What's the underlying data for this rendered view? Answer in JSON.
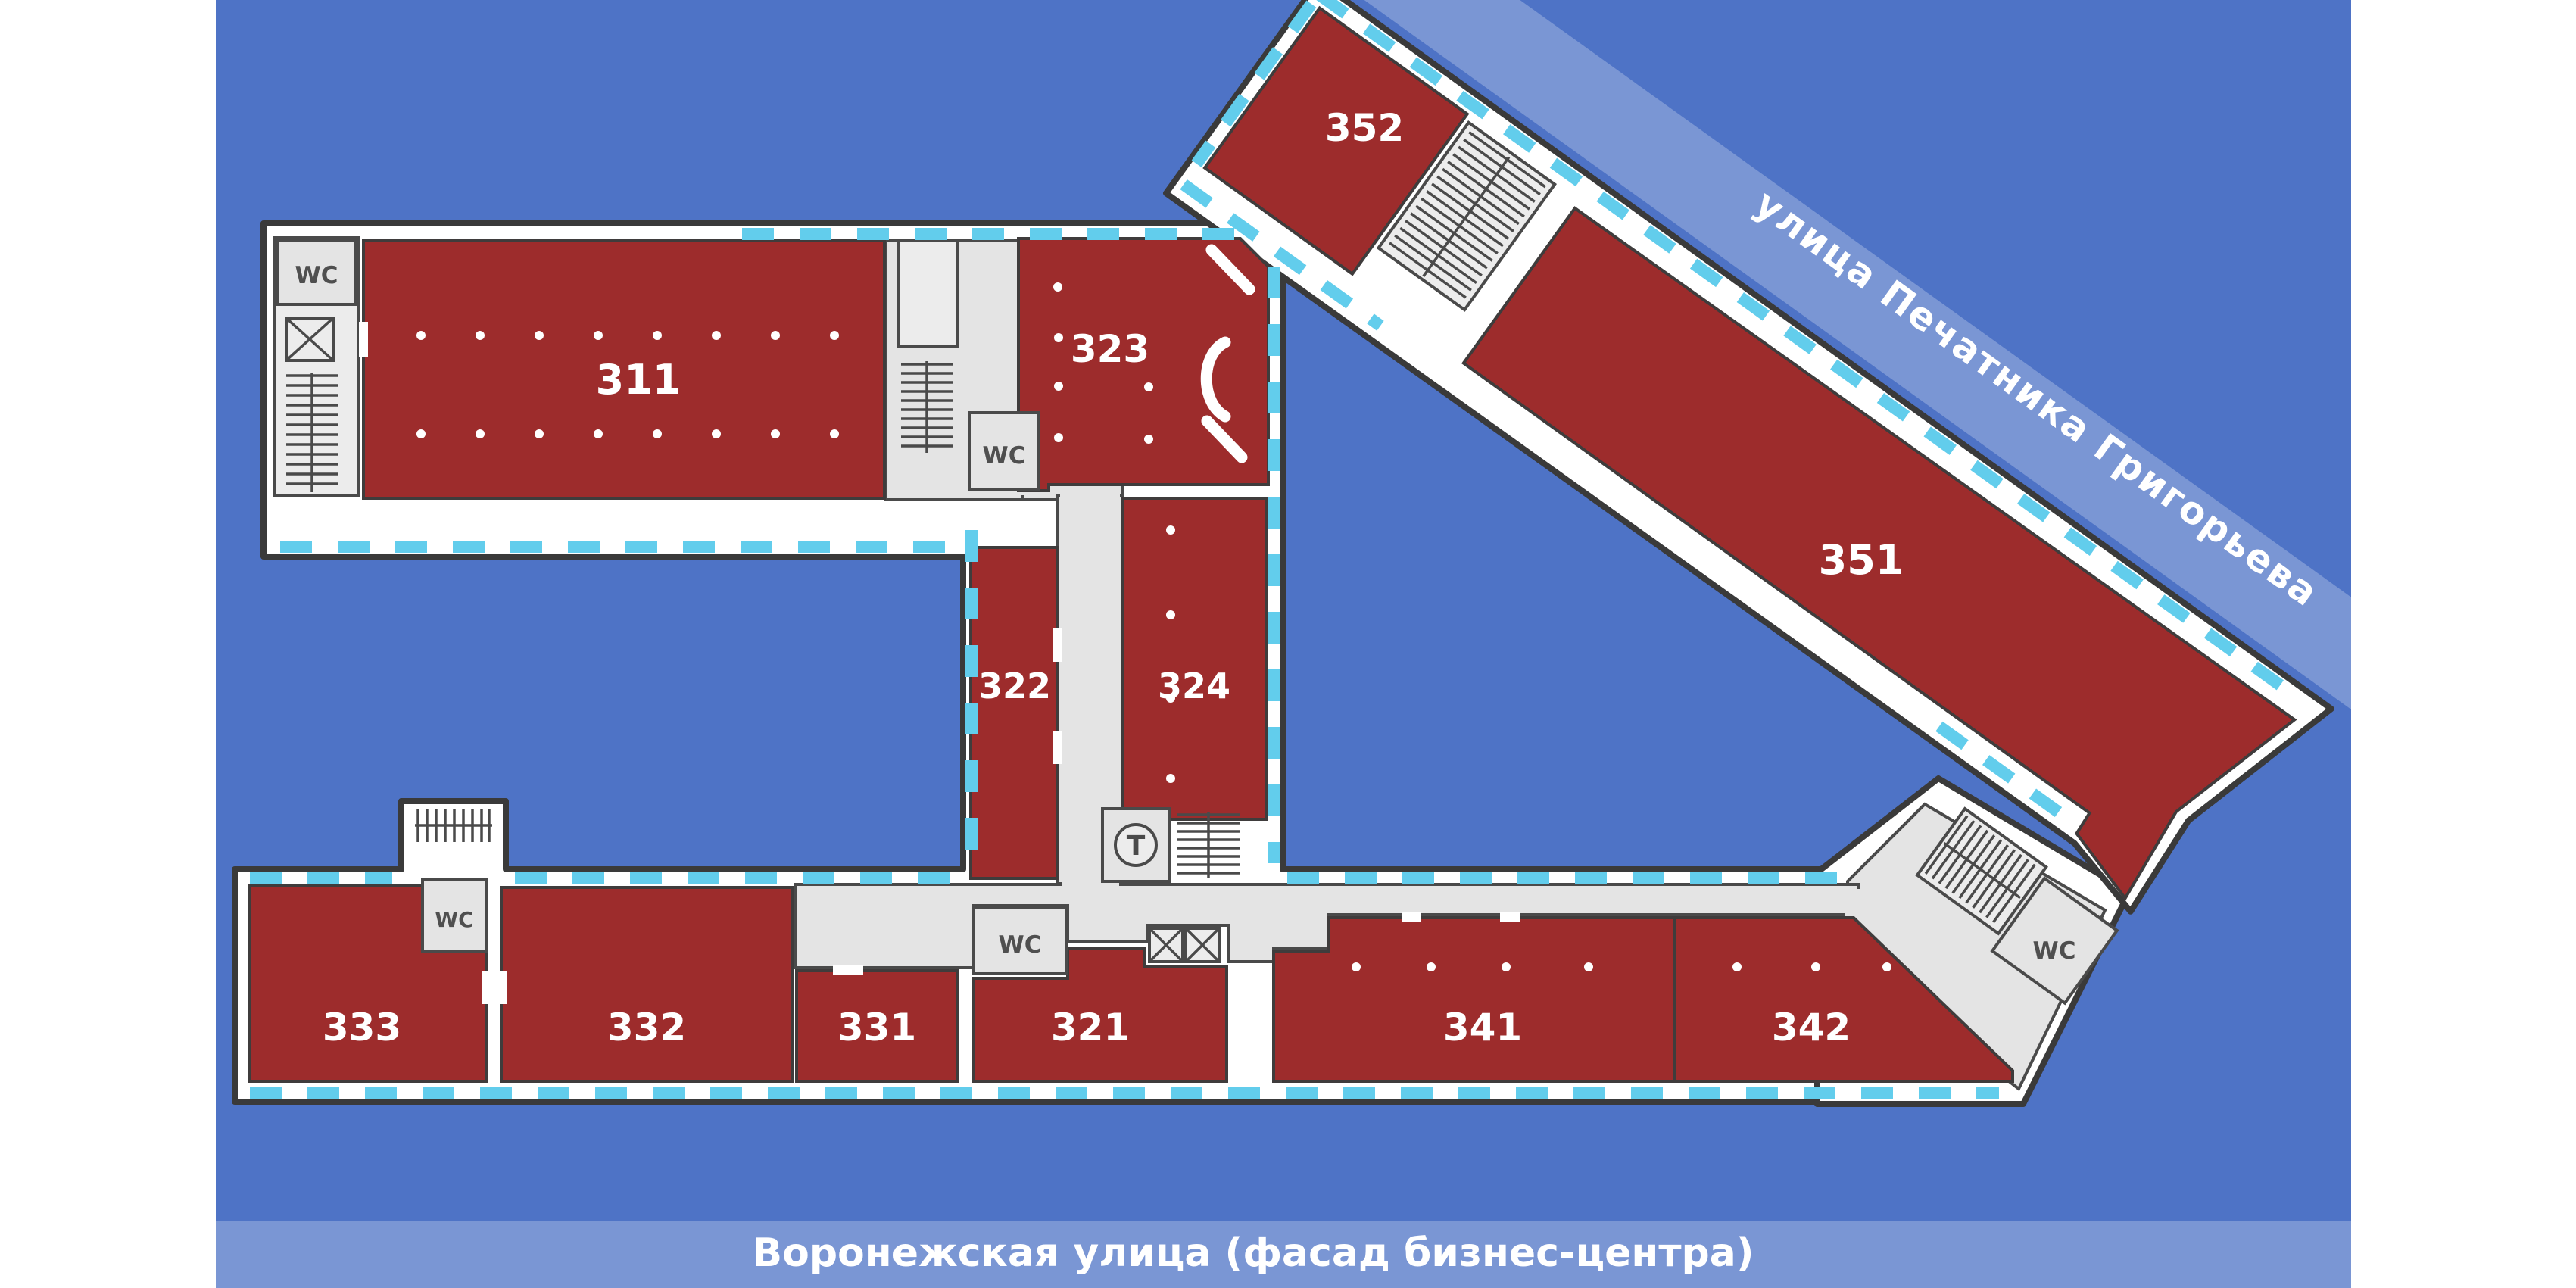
{
  "streets": {
    "diagonal_label": "улица Печатника Григорьева",
    "bottom_label": "Воронежская улица (фасад бизнес-центра)"
  },
  "rooms": {
    "r311": "311",
    "r321": "321",
    "r322": "322",
    "r323": "323",
    "r324": "324",
    "r331": "331",
    "r332": "332",
    "r333": "333",
    "r341": "341",
    "r342": "342",
    "r351": "351",
    "r352": "352"
  },
  "labels": {
    "wc": "WC",
    "t": "T"
  },
  "colors": {
    "page_background": "#ffffff",
    "map_blue": "#4e73c6",
    "street_band": "rgba(255,255,255,0.25)",
    "room_red": "#9d2c2c",
    "wall_white": "#ffffff",
    "outline_dark": "#3a3a3a",
    "interior_gray": "#e4e4e4",
    "window_cyan": "#62cdec",
    "label_white": "#ffffff",
    "wc_text": "#4f4f4f"
  }
}
